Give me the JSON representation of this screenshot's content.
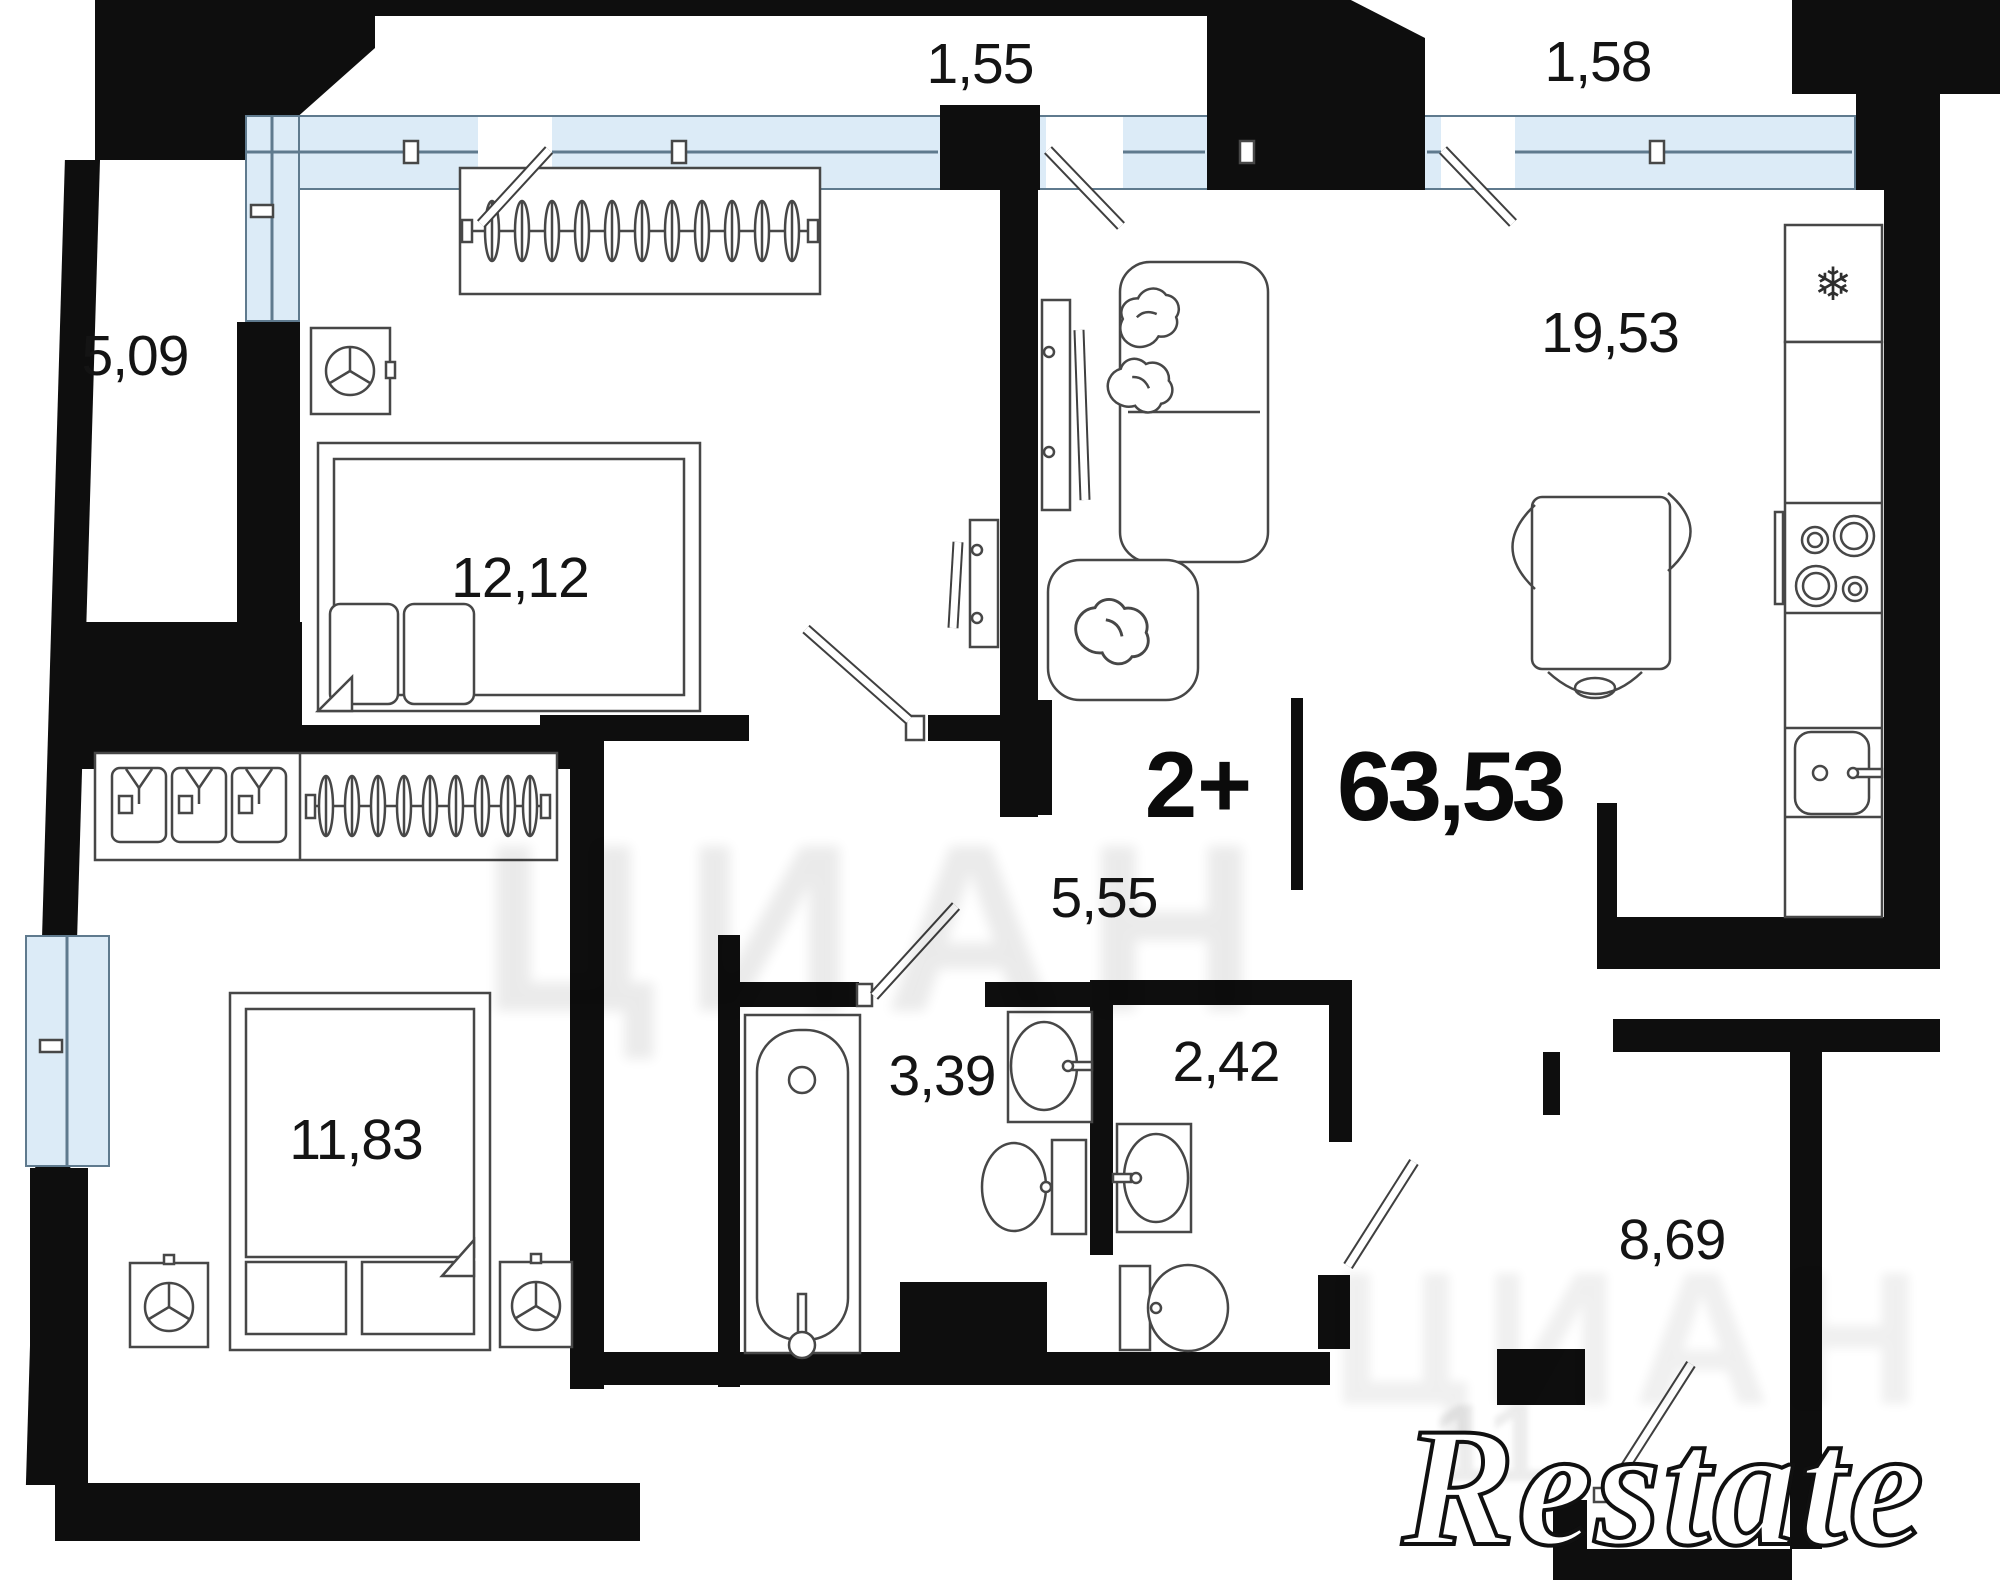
{
  "unit": {
    "rooms_type": "2+",
    "total_area": "63,53"
  },
  "rooms": [
    {
      "name": "balcony-left",
      "area": "5,09"
    },
    {
      "name": "balcony-top-left",
      "area": "1,55"
    },
    {
      "name": "balcony-top-right",
      "area": "1,58"
    },
    {
      "name": "kitchen-living",
      "area": "19,53"
    },
    {
      "name": "bedroom-top",
      "area": "12,12"
    },
    {
      "name": "bedroom-bottom",
      "area": "11,83"
    },
    {
      "name": "hallway",
      "area": "5,55"
    },
    {
      "name": "bathroom",
      "area": "3,39"
    },
    {
      "name": "toilet",
      "area": "2,42"
    },
    {
      "name": "entry-hall",
      "area": "8,69"
    }
  ],
  "icons": {
    "snowflake": "❄"
  },
  "watermarks": {
    "brand": "Restate",
    "portal": "ЦИАН",
    "digits": "11"
  },
  "colors": {
    "wall": "#0e0e0e",
    "glazing": "#dcebf7",
    "glazing_frame": "#5f7a8e",
    "line": "#474747"
  }
}
